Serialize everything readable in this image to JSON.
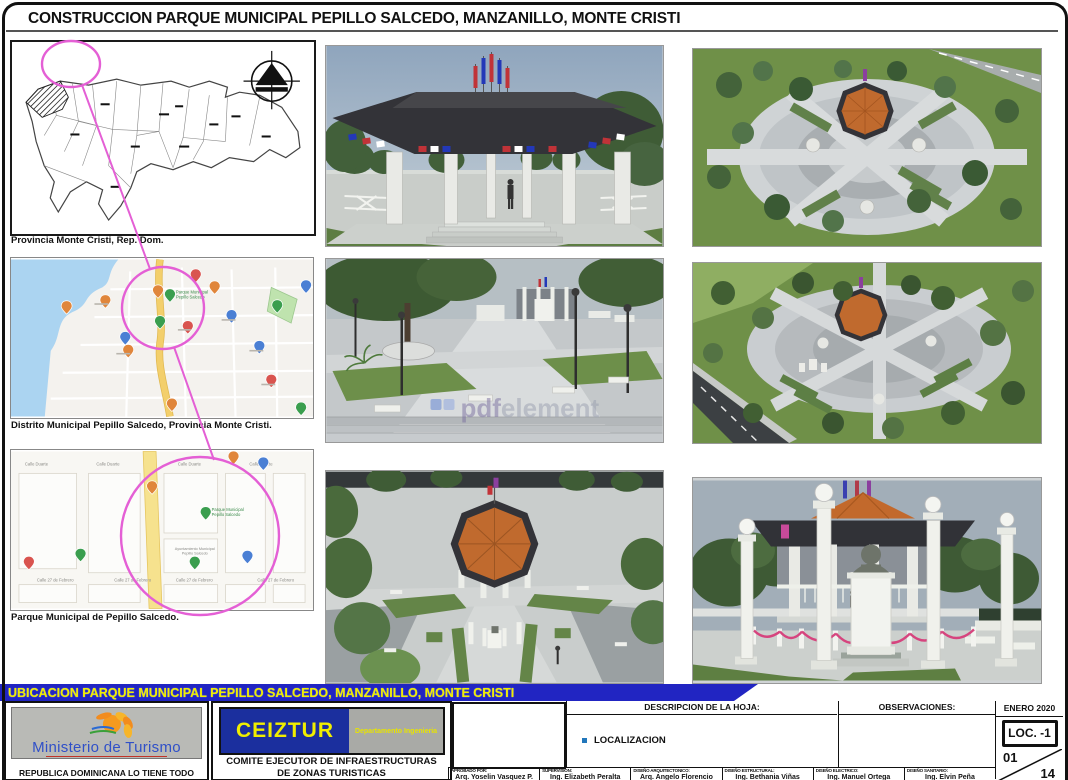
{
  "colors": {
    "banner-blue": "#2125c2",
    "banner-yellow": "#f0ee00",
    "highlight-pink": "#e45fd5",
    "roof-orange": "#c06a2e",
    "roof-dark": "#333338",
    "ministerio-blue": "#3050c8",
    "ceiztur-navy": "#1b2f9e",
    "map-water": "#abd4f1",
    "map-road-yellow": "#f6e28e",
    "grass-green": "#6f9048"
  },
  "sheet": {
    "title": "CONSTRUCCION PARQUE MUNICIPAL PEPILLO SALCEDO, MANZANILLO, MONTE CRISTI"
  },
  "maps": [
    {
      "caption": "Provincia Monte Cristi, Rep. Dom."
    },
    {
      "caption": "Distrito Municipal Pepillo Salcedo, Provincia Monte Cristi.",
      "park_label_line1": "Parque Municipal",
      "park_label_line2": "Pepillo Salcedo"
    },
    {
      "caption": "Parque Municipal de Pepillo Salcedo.",
      "street_top": "Calle Duarte",
      "street_bottom": "Calle 27 de Febrero",
      "park_label_line1": "Parque Municipal",
      "park_label_line2": "Pepillo Salcedo",
      "ayuntamiento_line1": "Ayuntamiento Municipal",
      "ayuntamiento_line2": "Pepillo Salcedo"
    }
  ],
  "watermark": {
    "bold": "pdf",
    "light": "element"
  },
  "banner": {
    "text": "UBICACION PARQUE MUNICIPAL PEPILLO SALCEDO, MANZANILLO, MONTE CRISTI"
  },
  "titleblock": {
    "ministerio_name": "Ministerio de Turismo",
    "ministerio_slogan": "REPUBLICA DOMINICANA LO TIENE TODO",
    "ceiztur_acronym": "CEIZTUR",
    "ceiztur_dept": "Departamento Ingenieria",
    "committee_line1": "COMITE EJECUTOR DE INFRAESTRUCTURAS",
    "committee_line2": "DE ZONAS TURISTICAS",
    "descripcion_label": "DESCRIPCION DE LA HOJA:",
    "descripcion_value": "LOCALIZACION",
    "observaciones_label": "OBSERVACIONES:",
    "date": "ENERO 2020",
    "sheet_code": "LOC. -1",
    "page_number": "01",
    "page_total": "14",
    "signatures": [
      {
        "role": "APROBADO POR:",
        "name": "Arq. Yoselin Vasquez P."
      },
      {
        "role": "SUPERVISION:",
        "name": "Ing. Elizabeth Peralta"
      },
      {
        "role": "DISEÑO ARQUITECTONICO:",
        "name": "Arq. Angelo Florencio"
      },
      {
        "role": "DISEÑO ESTRUCTURAL:",
        "name": "Ing. Bethania Viñas"
      },
      {
        "role": "DISEÑO ELECTRICO:",
        "name": "Ing. Manuel Ortega"
      },
      {
        "role": "DISEÑO SANITARIO:",
        "name": "Ing. Elvin Peña"
      }
    ]
  }
}
